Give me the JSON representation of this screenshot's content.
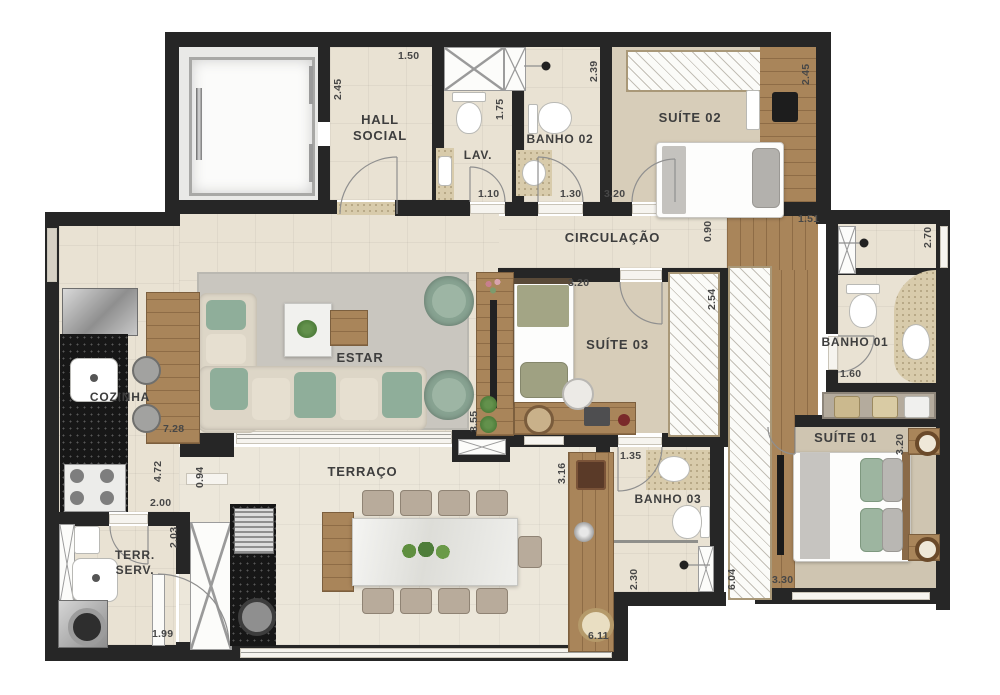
{
  "rooms": {
    "hall_social": {
      "label": "HALL\nSOCIAL"
    },
    "lav": {
      "label": "LAV."
    },
    "banho02": {
      "label": "BANHO 02"
    },
    "suite02": {
      "label": "SUÍTE 02"
    },
    "circulacao": {
      "label": "CIRCULAÇÃO"
    },
    "estar": {
      "label": "ESTAR"
    },
    "cozinha": {
      "label": "COZINHA"
    },
    "suite03": {
      "label": "SUÍTE 03"
    },
    "banho01": {
      "label": "BANHO 01"
    },
    "suite01": {
      "label": "SUÍTE 01"
    },
    "terraco": {
      "label": "TERRAÇO"
    },
    "banho03": {
      "label": "BANHO 03"
    },
    "terr_serv": {
      "label": "TERR.\nSERV."
    }
  },
  "dims": {
    "hall_h": "2.45",
    "hall_w": "1.50",
    "lav_h": "1.75",
    "lav_w": "1.10",
    "banho02_h": "2.39",
    "banho02_w": "1.30",
    "suite02_w": "3.20",
    "suite02_h": "2.45",
    "corr_right": "1.51",
    "circ_h": "0.90",
    "banho01_h": "2.70",
    "banho01_w": "1.60",
    "ward_suite03": "2.54",
    "suite03_w": "3.20",
    "suite01_h": "3.20",
    "suite01_w": "3.30",
    "estar_w": "7.28",
    "estar_h": "4.72",
    "passage": "0.94",
    "estar_d": "3.55",
    "terraco_h": "3.16",
    "terraco_w": "6.11",
    "banho03_w": "1.35",
    "banho03_h": "2.30",
    "closet_h": "6.04",
    "tserv_w": "2.00",
    "tserv_h": "2.03",
    "tserv_d": "1.99"
  },
  "colors": {
    "wall": "#262626",
    "tile": "#e9e2d3",
    "tile_light": "#ece7da",
    "carpet": "#d7cdb9",
    "carpet_dark": "#cfc5b1",
    "wood": "#a9855a",
    "rug": "#c9c6bf",
    "counter_beige": "#d8cbab",
    "sofa_green": "#8fae9a",
    "sofa_beige": "#ddd6c7",
    "marble": "#f1f1ee",
    "plant_green": "#4e7d3a"
  }
}
